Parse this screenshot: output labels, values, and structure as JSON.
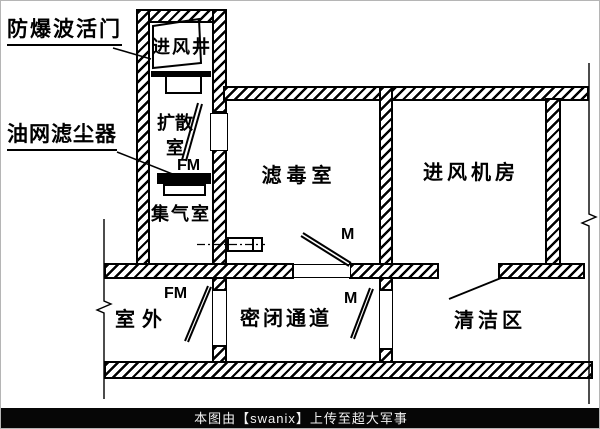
{
  "diagram": {
    "annotations": {
      "blast_valve": "防爆波活门",
      "oil_filter": "油网滤尘器"
    },
    "rooms": {
      "intake_shaft": "进风井",
      "diffusion_room": "扩散\n室",
      "gas_collection_room": "集气室",
      "filter_room": "滤毒室",
      "fan_room": "进风机房",
      "outdoor": "室外",
      "sealed_passage": "密闭通道",
      "clean_area": "清洁区"
    },
    "door_tags": {
      "fm_diffusion": "FM",
      "m_filter_room": "M",
      "fm_outdoor": "FM",
      "m_passage": "M"
    },
    "colors": {
      "ink": "#000000",
      "paper": "#ffffff",
      "footer_bg": "#060606",
      "footer_text": "#f2f2f2"
    }
  },
  "footer": {
    "credit": "本图由【swanix】上传至超大军事"
  }
}
